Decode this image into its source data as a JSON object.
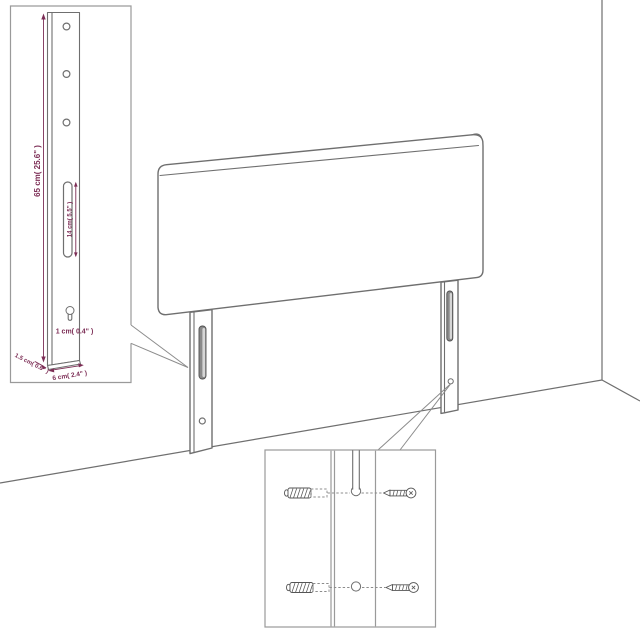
{
  "dimensions": {
    "leg_height": "65 cm( 25.6\" )",
    "slot_length": "14 cm( 5.5\" )",
    "hole_diameter": "1 cm( 0.4\" )",
    "leg_thickness": "1.5 cm( 0.6\" )",
    "leg_width": "6 cm( 2.4\" )"
  },
  "colors": {
    "dimension": "#7c2d55",
    "line": "#6f6f6f",
    "inset_border": "#9a9a9a",
    "leader": "#8c8c8c",
    "hardware": "#555555",
    "slot_fill": "#8a8a8a",
    "slot_highlight": "#d6d6d6"
  }
}
